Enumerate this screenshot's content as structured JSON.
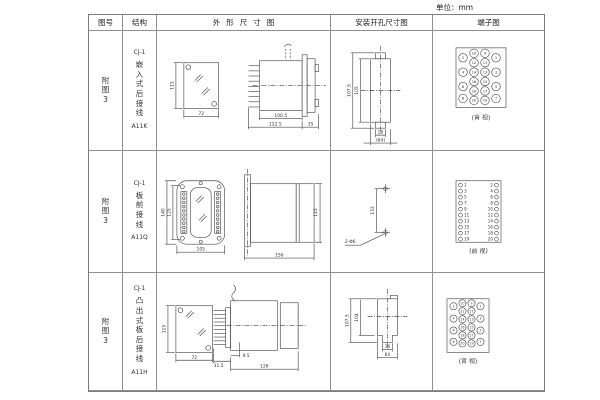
{
  "unit_label": "单位：mm",
  "header": {
    "fig_no": "图号",
    "structure": "结构",
    "outline": "外形尺寸图",
    "install": "安装开孔尺寸图",
    "terminal": "端子图"
  },
  "rows": [
    {
      "fig_no": [
        "附",
        "图",
        "3"
      ],
      "structure": [
        "CJ-1",
        "嵌",
        "入",
        "式",
        "后",
        "接",
        "线",
        "A11K"
      ],
      "outline_dims": {
        "height": "115",
        "width": "72",
        "body_len": "100.5",
        "total_len": "122.5",
        "flange": "35"
      },
      "install_dims": {
        "outer_h": "107.5",
        "inner_h": "105",
        "notch_w": "16",
        "panel_w": "(64)"
      },
      "terminal": {
        "view_label": "(背 视)",
        "columns": [
          [
            2,
            4,
            6,
            8
          ],
          [
            10,
            12,
            14,
            16,
            18,
            20
          ],
          [
            9,
            11,
            13,
            15,
            17,
            19
          ],
          [
            1,
            3,
            5,
            7
          ]
        ]
      }
    },
    {
      "fig_no": [
        "附",
        "图",
        "3"
      ],
      "structure": [
        "CJ-1",
        "板",
        "前",
        "接",
        "线",
        "A11Q"
      ],
      "outline_dims": {
        "outer_h": "140",
        "inner_h": "125",
        "width": "105",
        "depth": "156",
        "side_h": "115"
      },
      "install_dims": {
        "hole_spacing": "133",
        "holes": "2-Φ6"
      },
      "terminal": {
        "view_label": "(前 视)",
        "left": [
          1,
          3,
          5,
          7,
          9,
          11,
          13,
          15,
          17,
          19
        ],
        "right": [
          2,
          4,
          6,
          8,
          10,
          12,
          14,
          16,
          18,
          20
        ]
      }
    },
    {
      "fig_no": [
        "附",
        "图",
        "3"
      ],
      "structure": [
        "CJ-1",
        "凸",
        "出",
        "式",
        "板",
        "后",
        "接",
        "线",
        "A11H"
      ],
      "outline_dims": {
        "height": "115",
        "width": "72",
        "pin_len": "31.5",
        "offset": "9.5",
        "body_len": "126"
      },
      "install_dims": {
        "outer_h": "107.5",
        "inner_h": "104",
        "notch_w": "16",
        "panel_w": "64"
      },
      "terminal": {
        "view_label": "(背 视)",
        "columns": [
          [
            2,
            4,
            6,
            8
          ],
          [
            10,
            12,
            14,
            16,
            18,
            20
          ],
          [
            9,
            11,
            13,
            15,
            17,
            19
          ],
          [
            1,
            3,
            5,
            7
          ]
        ]
      }
    }
  ]
}
